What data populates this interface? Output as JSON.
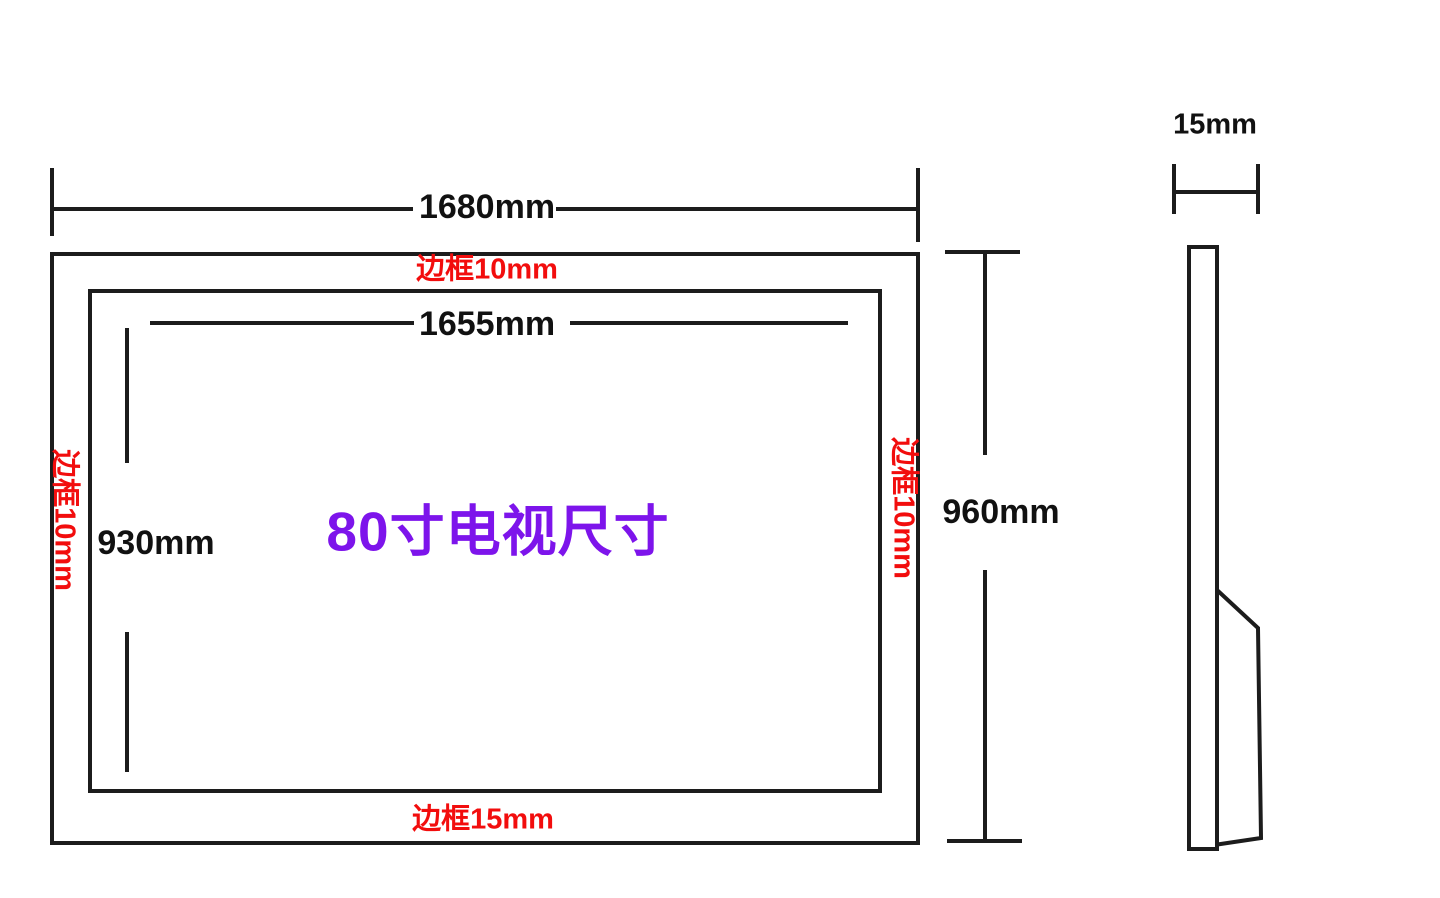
{
  "diagram": {
    "title": "80寸电视尺寸",
    "front_view": {
      "outer_width": "1680mm",
      "outer_height": "960mm",
      "screen_width": "1655mm",
      "screen_height": "930mm",
      "bezel_top": "边框10mm",
      "bezel_left": "边框10mm",
      "bezel_right": "边框10mm",
      "bezel_bottom": "边框15mm"
    },
    "side_view": {
      "thickness": "15mm"
    },
    "colors": {
      "line": "#1c1c1c",
      "dimension_text": "#111111",
      "bezel_text": "#f20d0d",
      "title_text": "#7d14eb",
      "background": "#ffffff"
    }
  }
}
